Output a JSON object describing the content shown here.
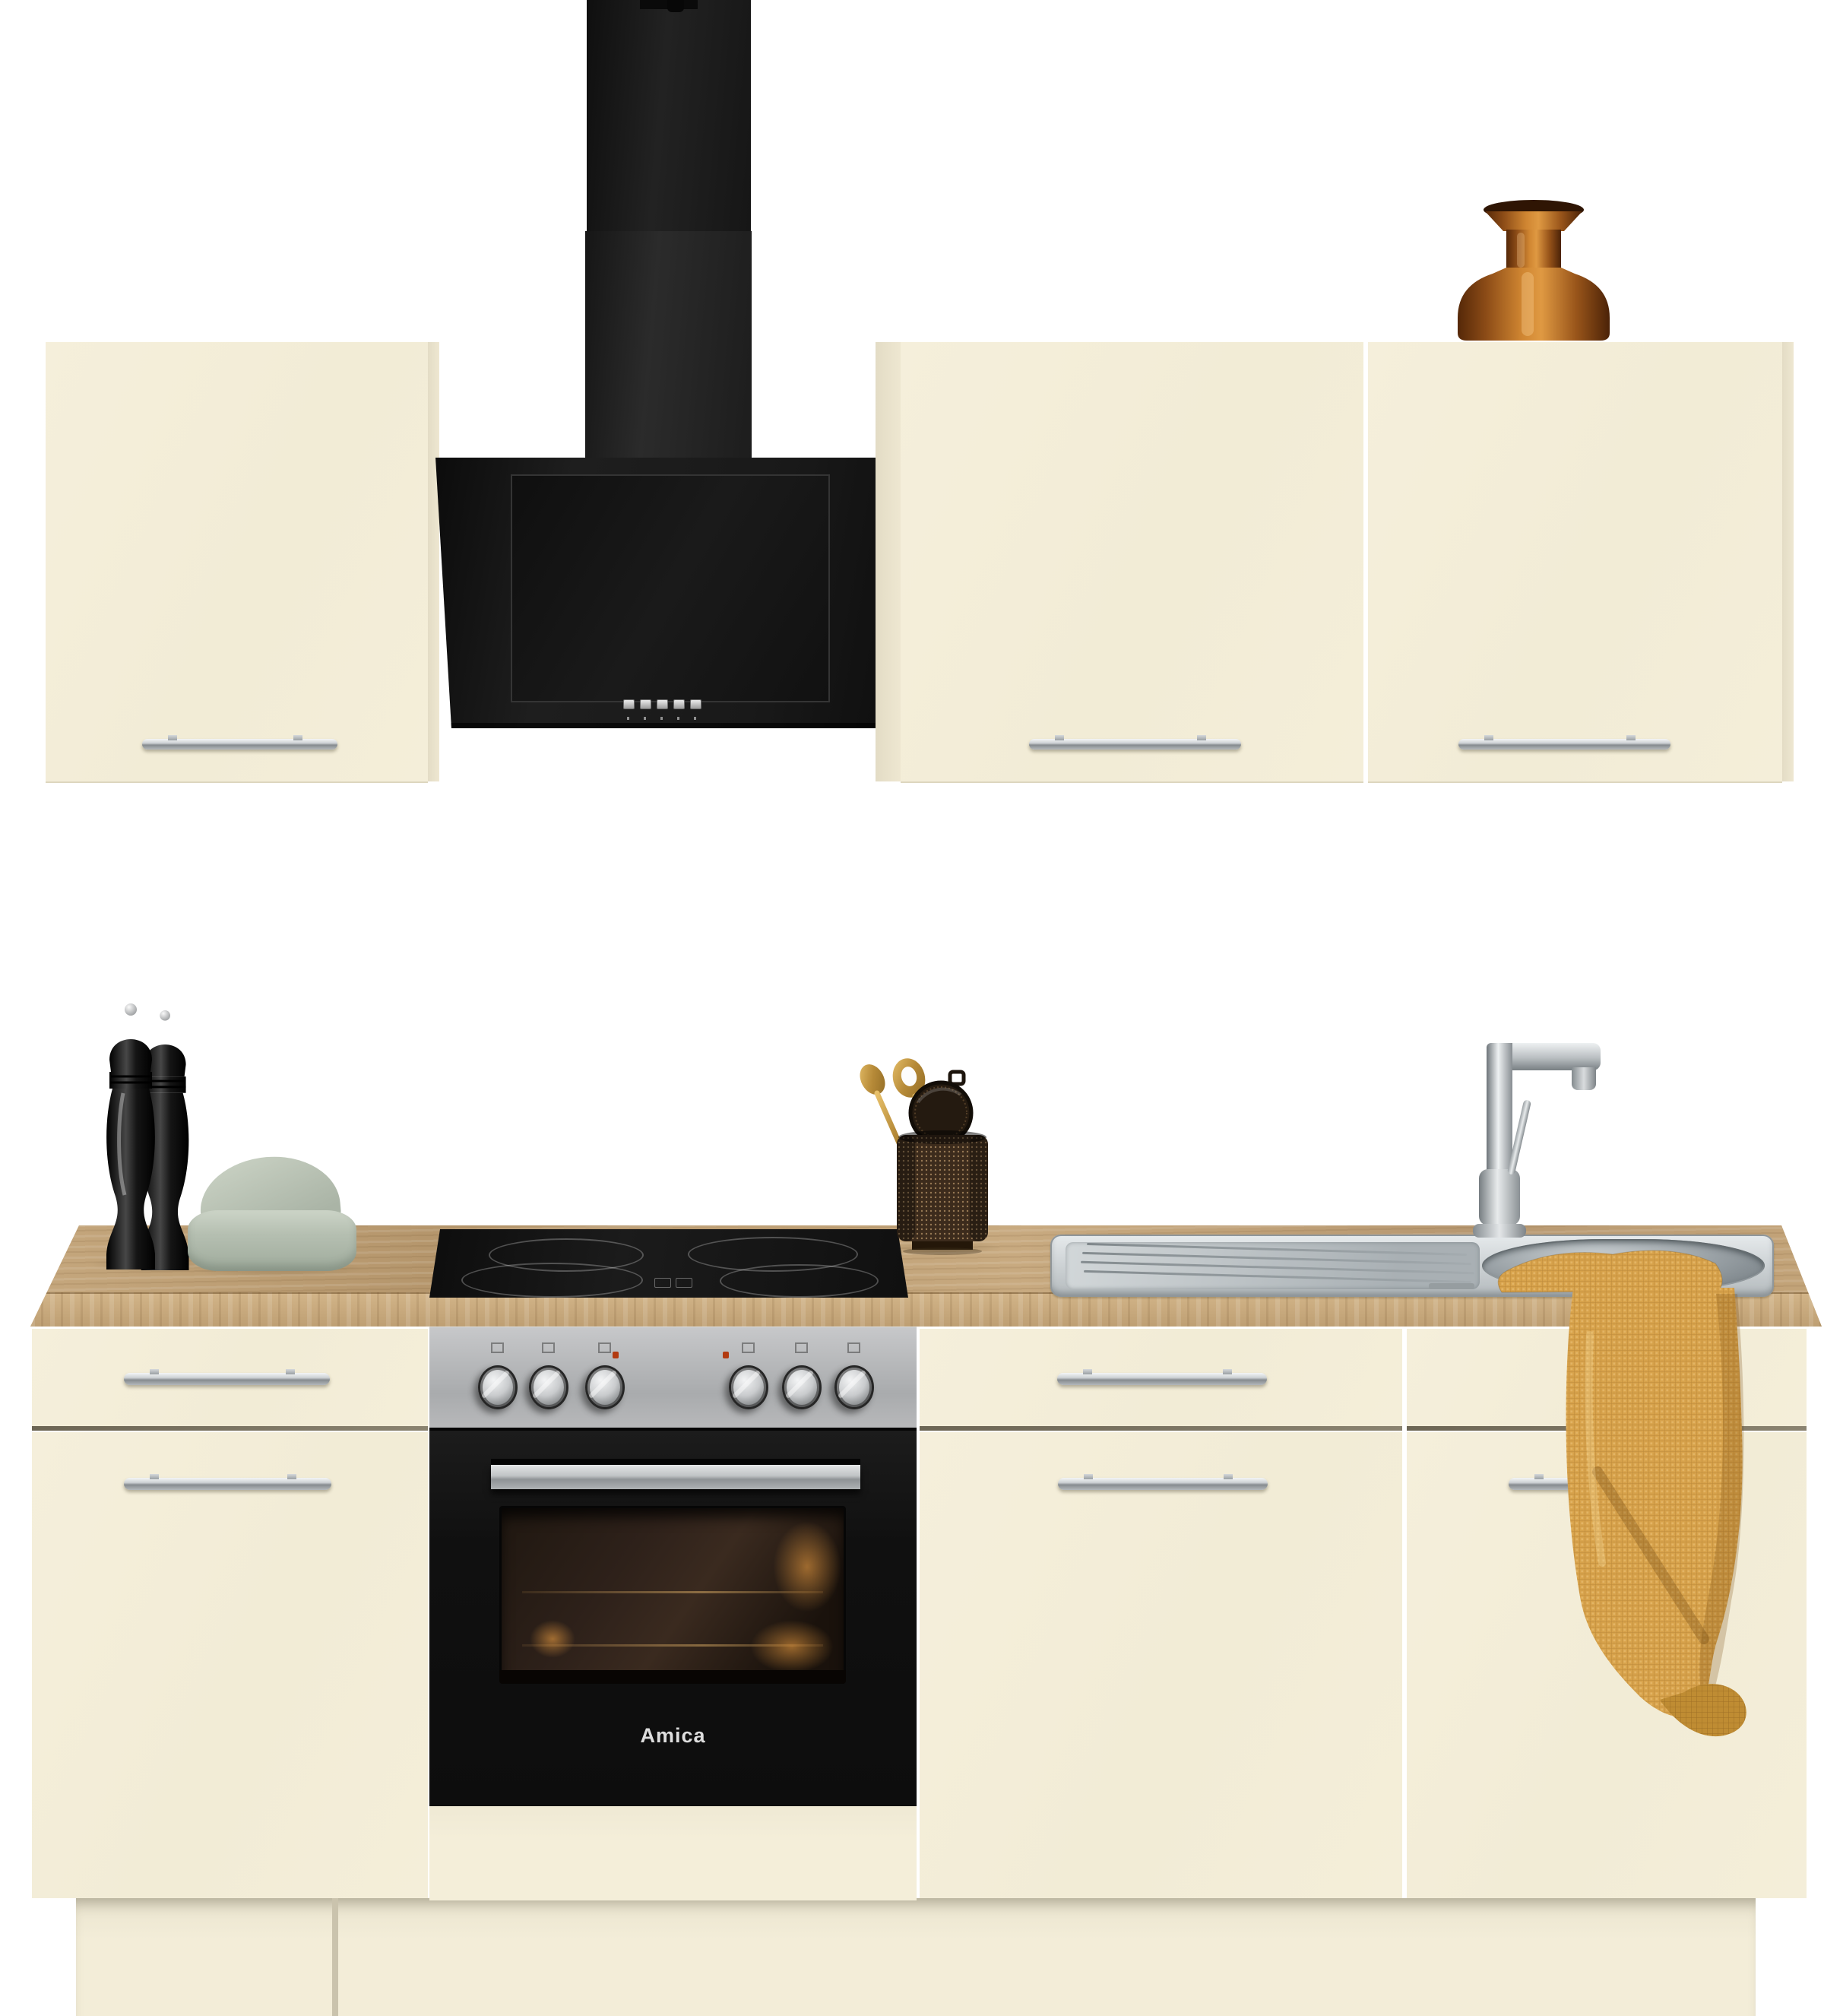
{
  "scene": {
    "type": "product photo",
    "subject": "Cream kitchen unit with black chimney hood, built-in oven, ceramic hob, stainless sink and oak worktop",
    "background_color": "#ffffff"
  },
  "oven": {
    "brand_label": "Amica",
    "knob_count": 6,
    "indicator_dot_color": "#b23a10",
    "finish": "stainless and black"
  },
  "hood": {
    "button_count": 5,
    "color": "#161616"
  },
  "cooktop": {
    "burner_count": 4,
    "color": "#121212"
  },
  "cabinets": {
    "wall_cabinet_count": 3,
    "base_cabinet_count": 3,
    "front_color": "#f3edd8",
    "handle_finish": "chrome"
  },
  "worktop": {
    "color": "#c2a277",
    "material": "light oak"
  },
  "sink": {
    "finish": "stainless",
    "has_drainboard": true,
    "faucet": "chrome single-lever"
  },
  "decor": {
    "items": [
      "pepper mill",
      "pepper mill",
      "sage storage box",
      "utensil cup",
      "gold spoon",
      "gold slotted spoon",
      "mesh strainer",
      "amber glass vase",
      "mustard kitchen towel"
    ],
    "towel_color": "#d7a24b",
    "vase_color": "#9a5a1e",
    "box_color": "#b7c0b2"
  }
}
